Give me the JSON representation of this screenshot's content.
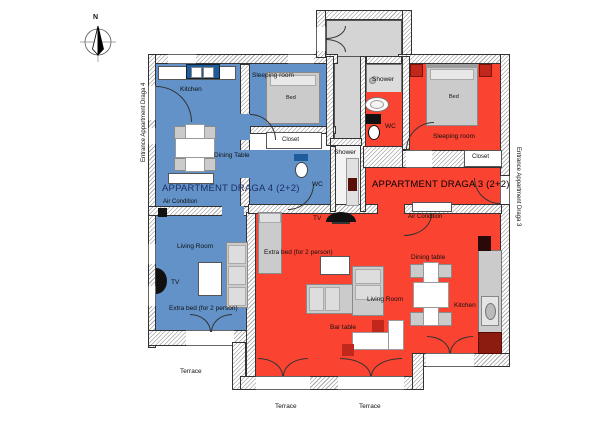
{
  "colors": {
    "apt4_blue": "#6292c8",
    "apt4_dark": "#1e5c9e",
    "apt3_red": "#fb4331",
    "apt3_dark": "#c1271a",
    "common_gray": "#d4d4d4",
    "furniture_gray": "#cbcbcb",
    "title4_text": "#1c2e66",
    "title3_text": "#000000"
  },
  "compass": {
    "north": "N"
  },
  "entrance_left": "Entrance Appartment Draga 4",
  "entrance_right": "Entrance Appartment Draga 3",
  "apt4": {
    "title": "APPARTMENT DRAGA 4 (2+2)",
    "kitchen": "Kitchen",
    "sleeping_room": "Sleeping room",
    "bed": "Bed",
    "closet": "Closet",
    "dining_table": "Dining Table",
    "wc": "WC",
    "shower": "Shower",
    "air_condition": "Air Condition",
    "living_room": "Living Room",
    "tv": "TV",
    "extra_bed": "Extra bed (for 2 person)",
    "terrace": "Terrace"
  },
  "apt3": {
    "title": "APPARTMENT DRAGA 3 (2+2)",
    "shower": "Shower",
    "wc": "WC",
    "bed": "Bed",
    "sleeping_room": "Sleeping room",
    "closet": "Closet",
    "air_condition": "Air Condition",
    "tv": "TV",
    "extra_bed": "Extra bed (for 2 person)",
    "dining_table": "Dining table",
    "living_room": "Living Room",
    "kitchen": "Kitchen",
    "bar_table": "Bar table",
    "terrace_1": "Terrace",
    "terrace_2": "Terrace"
  }
}
